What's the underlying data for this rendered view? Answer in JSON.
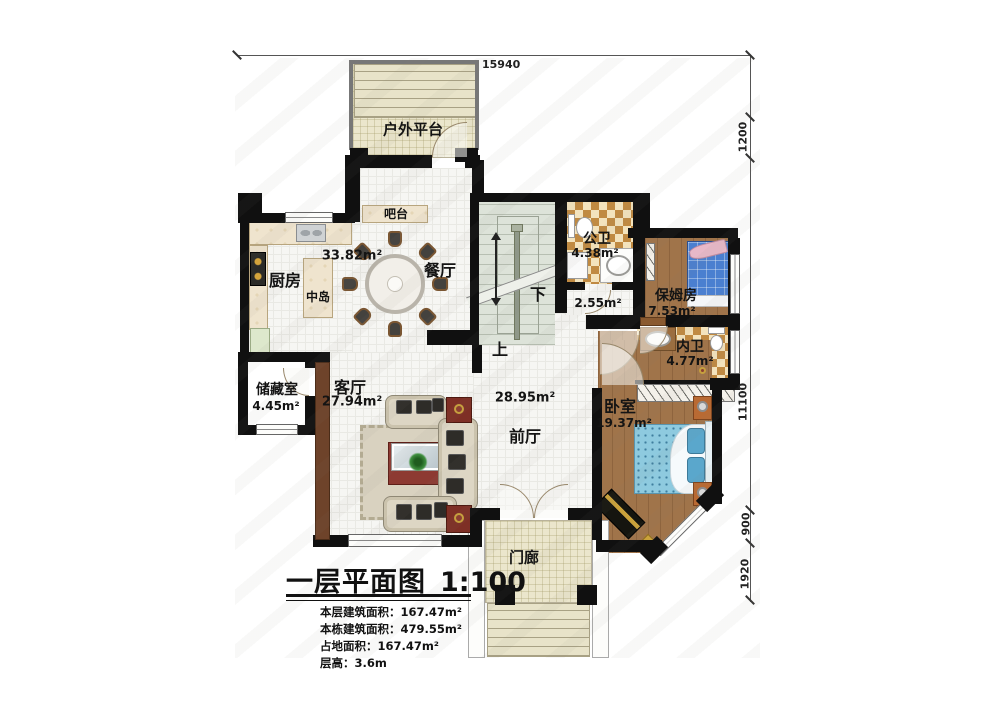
{
  "plan": {
    "rooms": {
      "outdoor_platform": {
        "name": "户外平台"
      },
      "bar_counter": {
        "name": "吧台"
      },
      "kitchen": {
        "name": "厨房"
      },
      "center_island": {
        "name": "中岛"
      },
      "dining_room": {
        "name": "餐厅"
      },
      "kitchen_dining": {
        "area": "33.82m²"
      },
      "public_bathroom": {
        "name": "公卫",
        "area": "4.38m²"
      },
      "hallway": {
        "area": "2.55m²"
      },
      "nanny_room": {
        "name": "保姆房",
        "area": "7.53m²"
      },
      "private_bathroom": {
        "name": "内卫",
        "area": "4.77m²"
      },
      "storage_room": {
        "name": "储藏室",
        "area": "4.45m²"
      },
      "living_room": {
        "name": "客厅",
        "area": "27.94m²"
      },
      "front_hall": {
        "name": "前厅",
        "area": "28.95m²"
      },
      "bedroom": {
        "name": "卧室",
        "area": "19.37m²"
      },
      "porch": {
        "name": "门廊"
      }
    },
    "stairs": {
      "down_label": "下",
      "up_label": "上"
    },
    "dimensions": {
      "top_width": "15940",
      "right_side": [
        "1200",
        "11100",
        "900",
        "1920"
      ]
    }
  },
  "title_block": {
    "title": "一层平面图",
    "scale": "1:100",
    "info_lines": [
      "本层建筑面积：167.47m²",
      "本栋建筑面积：479.55m²",
      "占地面积：167.47m²",
      "层高：3.6m"
    ]
  },
  "colors": {
    "wall": "#101010",
    "wood_floor": "#a0744a",
    "checker_dark": "#c08a42",
    "checker_light": "#f3e3bd",
    "platform_tile": "#ebe6cc",
    "stair_fill": "#dde3d9",
    "nanny_bed_blue": "#4a7fd0",
    "bedroom_bed_blue": "#8ecadf",
    "rug_red": "#8d3a32"
  }
}
